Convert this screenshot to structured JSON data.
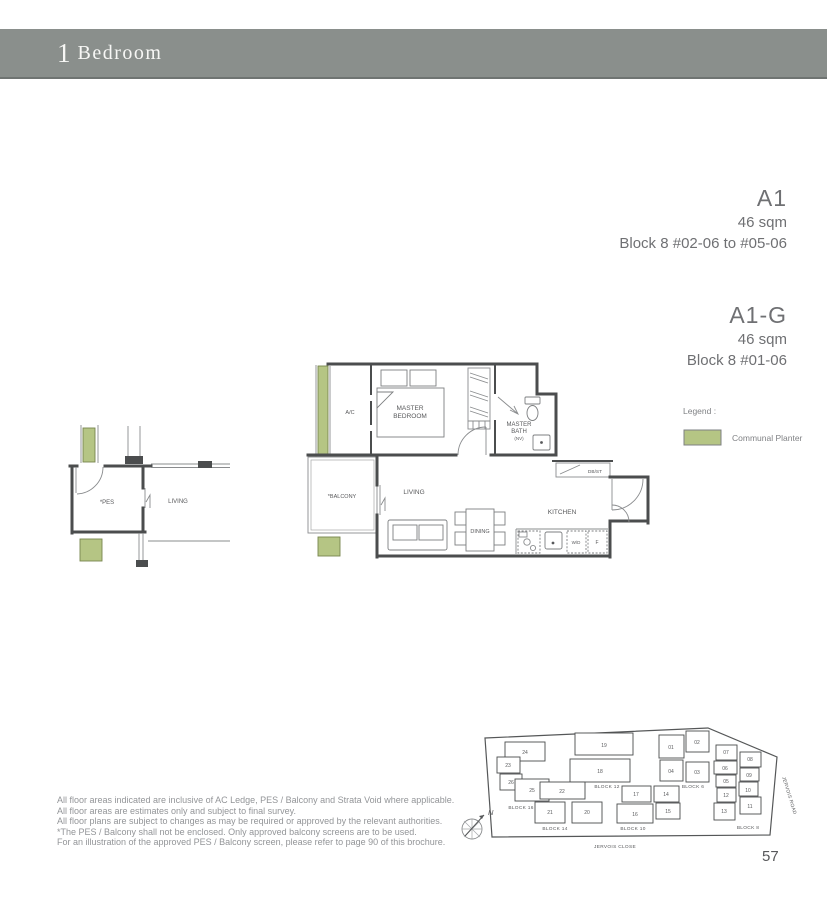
{
  "banner": {
    "number": "1",
    "label": "Bedroom"
  },
  "colors": {
    "banner_bg": "#8a8f8c",
    "planter_green": "#b5c584",
    "unit_highlight": "#8d8d8d"
  },
  "units": [
    {
      "title": "A1",
      "area": "46 sqm",
      "levels": "Block 8 #02-06 to #05-06"
    },
    {
      "title": "A1-G",
      "area": "46 sqm",
      "levels": "Block 8 #01-06"
    }
  ],
  "legend": {
    "title": "Legend :",
    "item": "Communal Planter"
  },
  "floorplan": {
    "main": {
      "ac": "A/C",
      "bed1": "MASTER",
      "bed2": "BEDROOM",
      "bath1": "MASTER",
      "bath2": "BATH",
      "bath3": "(NV)",
      "dbst": "DB/ST",
      "balcony": "*BALCONY",
      "living": "LIVING",
      "dining": "DINING",
      "kitchen": "KITCHEN",
      "wd": "W/D",
      "f": "F"
    },
    "ground": {
      "pes": "*PES",
      "living": "LIVING"
    }
  },
  "disclaimer": [
    "All floor areas indicated are inclusive of AC Ledge, PES / Balcony and Strata Void where applicable.",
    "All floor areas are estimates only and subject to final survey.",
    "All floor plans are subject to changes as may be required or approved by the relevant authorities.",
    "*The PES / Balcony shall not be enclosed. Only approved balcony screens are to be used.",
    "For an illustration of the approved PES / Balcony screen, please refer to page 90 of this brochure."
  ],
  "sitemap": {
    "compass": "N",
    "roads": {
      "close": "JERVOIS CLOSE",
      "road": "JERVOIS ROAD"
    },
    "blocks": {
      "b16": {
        "label": "BLOCK 16",
        "units": [
          "24",
          "23",
          "26",
          "25"
        ]
      },
      "b12": {
        "label": "BLOCK 12",
        "units": [
          "19",
          "18"
        ]
      },
      "b14": {
        "label": "BLOCK 14",
        "units": [
          "22",
          "21",
          "20"
        ]
      },
      "b10": {
        "label": "BLOCK 10",
        "units": [
          "17",
          "14",
          "16",
          "15"
        ]
      },
      "b6": {
        "label": "BLOCK 6",
        "units": [
          "01",
          "02",
          "04",
          "03"
        ]
      },
      "b8": {
        "label": "BLOCK 8",
        "units": [
          "07",
          "06",
          "05",
          "12",
          "13",
          "08",
          "09",
          "10",
          "11"
        ],
        "highlighted": "06"
      }
    }
  },
  "page_number": "57"
}
